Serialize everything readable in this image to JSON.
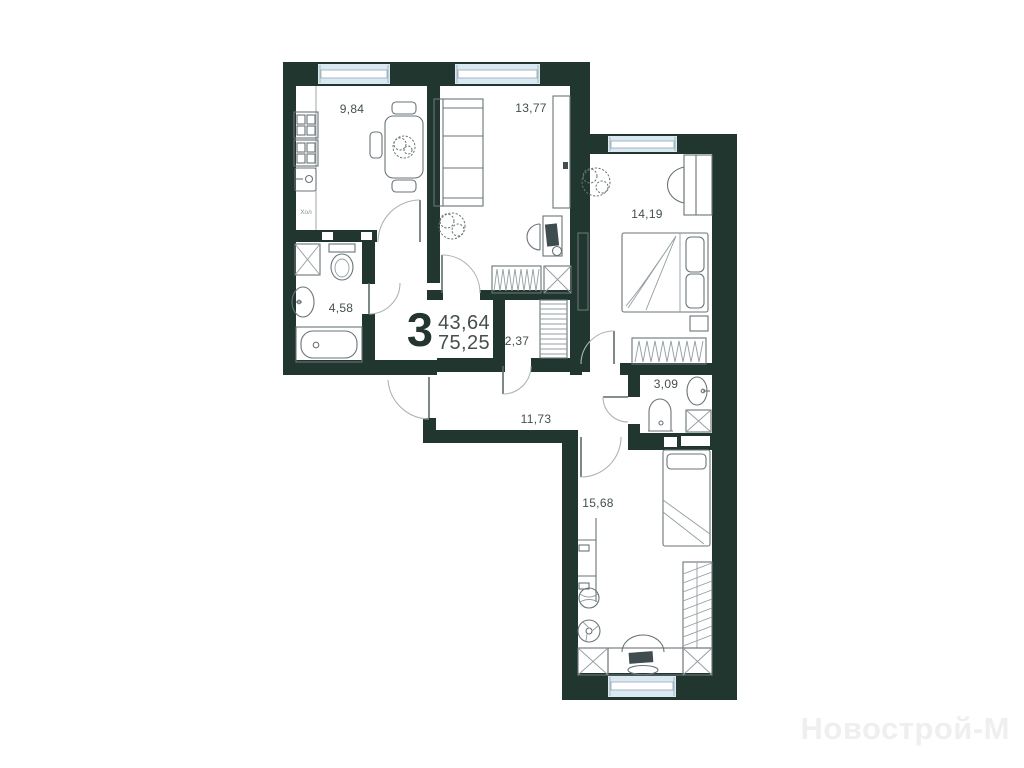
{
  "plan": {
    "summary": {
      "rooms_count": "3",
      "living_area": "43,64",
      "total_area": "75,25"
    },
    "rooms": [
      {
        "name": "kitchen",
        "area": "9,84"
      },
      {
        "name": "living-room",
        "area": "13,77"
      },
      {
        "name": "bedroom",
        "area": "14,19"
      },
      {
        "name": "bathroom",
        "area": "4,58"
      },
      {
        "name": "wardrobe",
        "area": "2,37"
      },
      {
        "name": "hallway",
        "area": "11,73"
      },
      {
        "name": "wc",
        "area": "3,09"
      },
      {
        "name": "bedroom-2",
        "area": "15,68"
      }
    ],
    "labels": {
      "fridge": "Хол"
    },
    "watermark": "Новострой-М",
    "colors": {
      "wall": "#21362f",
      "window": "#d9e8f1",
      "furniture_line": "#6a7477",
      "label": "#44504b",
      "accent": "#22362f",
      "watermark": "#efefef"
    }
  }
}
